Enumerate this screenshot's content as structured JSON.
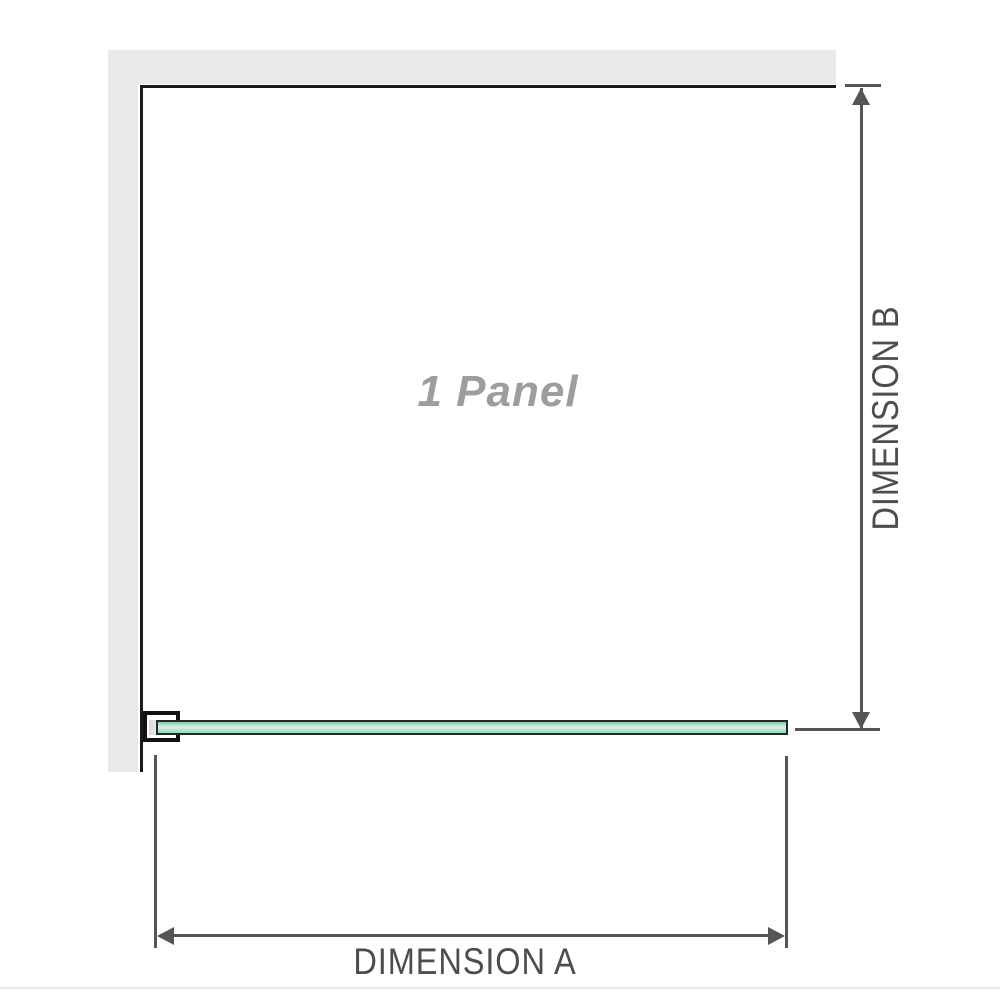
{
  "diagram": {
    "panel_label": "1 Panel",
    "dimension_a_label": "DIMENSION A",
    "dimension_b_label": "DIMENSION B"
  },
  "colors": {
    "wall": "#e9e9e9",
    "outline": "#1a1a1a",
    "dim": "#555555",
    "dim-text": "#4d4d4d",
    "watermark": "#9d9d9d",
    "glass-border": "#1f2d26",
    "glass-top": "#85c9a7",
    "glass-mid": "#d9f1e4",
    "glass-bottom": "#98d5b8",
    "bracket-pad": "#d9d9d9",
    "page-edge": "#e7e7e3"
  }
}
